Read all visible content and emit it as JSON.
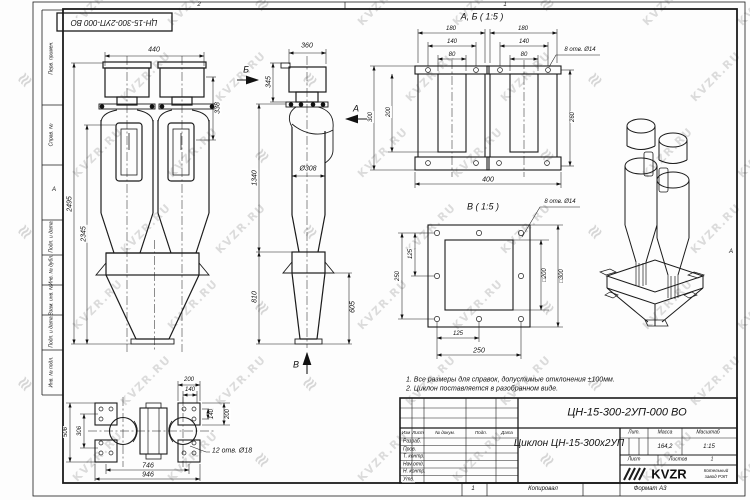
{
  "frame": {
    "top_doc": "ЦН-15-300-2УП-000 ВО",
    "zone_top_left": "2",
    "zone_top_right": "1",
    "zone_bottom": "1",
    "zone_side_left": "А",
    "zone_side_right": "А",
    "left_labels": [
      "Перв. примен.",
      "Справ. №",
      "Подп. и дата",
      "Инв. № дубл.",
      "Взам. инв. №",
      "Подп. и дата",
      "Инв. № подл."
    ]
  },
  "notes": {
    "line1": "1. Все размеры для справок, допустимые отклонения ±100мм.",
    "line2": "2. Циклон поставляется в разобранном виде."
  },
  "views": {
    "front": {
      "dim_width": "440",
      "dim_inlet": "338",
      "dim_height_total": "2495",
      "dim_height_body": "2345"
    },
    "side": {
      "dim_width": "360",
      "dim_top": "345",
      "dim_dia": "Ø308",
      "dim_mid": "1340",
      "dim_bunker": "810",
      "dim_cone": "605",
      "view_a": "А",
      "view_b": "Б",
      "view_v": "В"
    },
    "plan": {
      "dim_t1": "200",
      "dim_t2": "140",
      "dim_r1": "140",
      "dim_r2": "200",
      "dim_l1": "506",
      "dim_l2": "306",
      "dim_b1": "746",
      "dim_b2": "946",
      "holes_note": "12 отв. Ø18"
    },
    "section_ab": {
      "title": "А, Б ( 1:5 )",
      "holes_note": "8 отв. Ø14",
      "dim_w1": "180",
      "dim_w2": "140",
      "dim_w3": "80",
      "dim_h1": "300",
      "dim_h2": "200",
      "dim_h3": "260",
      "dim_total": "400"
    },
    "section_v": {
      "title": "В ( 1:5 )",
      "holes_note": "8 отв. Ø14",
      "dim_l1": "250",
      "dim_l2": "125",
      "dim_sq_inner": "□200",
      "dim_sq_outer": "□300",
      "dim_b1": "125",
      "dim_b2": "250"
    }
  },
  "title_block": {
    "designation": "ЦН-15-300-2УП-000 ВО",
    "name": "Циклон ЦН-15-300х2УП",
    "col_izm": "Изм",
    "col_list": "Лист",
    "col_doc": "№ докум.",
    "col_sign": "Подп.",
    "col_date": "Дата",
    "rows": [
      "Разраб.",
      "Пров.",
      "Т. контр.",
      "Нач.отд.",
      "Н. контр.",
      "Утв."
    ],
    "lit_label": "Лит.",
    "mass_label": "Масса",
    "scale_label": "Масштаб",
    "mass_value": "164,2",
    "scale_value": "1:15",
    "sheet_label": "Лист",
    "sheets_label": "Листов",
    "sheets_value": "1",
    "brand": "KVZR",
    "brand_line1": "Котельный",
    "brand_line2": "завод РЭП",
    "copied": "Копировал",
    "format": "Формат А3"
  },
  "watermark": {
    "text": "KVZR.RU",
    "glyph": "≋"
  }
}
